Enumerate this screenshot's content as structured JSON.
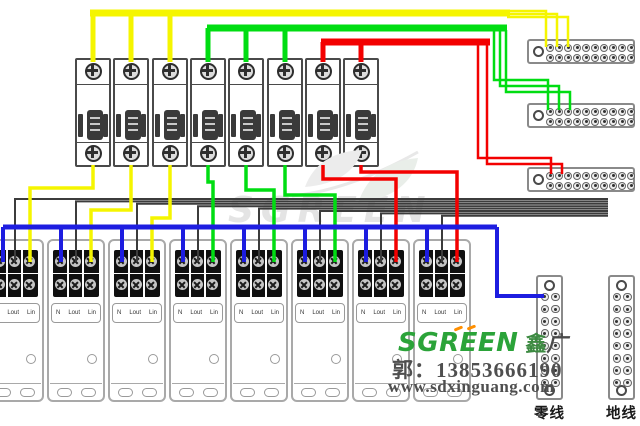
{
  "diagram": {
    "type": "electrical wiring diagram",
    "description": "Eight single-pole circuit breakers wired to eight single-phase energy meters; yellow/green/red phase buses feed terminal bus blocks, blue neutral bus feeds neutral strip"
  },
  "colors": {
    "yellow": "#f5f500",
    "green": "#00dd12",
    "red": "#f30000",
    "blue": "#1d1de0",
    "black": "#3c3c3c",
    "background": "#ffffff",
    "logo_green": "#2ba339",
    "logo_orange": "#ff8f00",
    "watermark_gray": "#e4e4e4"
  },
  "branding": {
    "logo_text": "SGREEN",
    "logo_cn_1": "鑫",
    "logo_cn_2": "广",
    "contact": "郭：13853666190",
    "website": "www.sdxinguang.com"
  },
  "watermark": {
    "text": "SGREEN"
  },
  "breakers": {
    "count": 8,
    "phases": [
      "yellow",
      "yellow",
      "yellow",
      "green",
      "green",
      "green",
      "red",
      "red"
    ]
  },
  "meters": {
    "count": 8,
    "terminal_labels": [
      "N",
      "Lout",
      "Lin"
    ]
  },
  "bus_blocks": {
    "count": 3,
    "rows": 2,
    "cols": 10,
    "feeds": [
      "yellow",
      "green",
      "red"
    ]
  },
  "strips": [
    {
      "label": "零线"
    },
    {
      "label": "地线"
    }
  ],
  "layout": {
    "breaker_xs": [
      75,
      113,
      152,
      190,
      228,
      267,
      305,
      343
    ],
    "meter_xs": [
      -14,
      47,
      108,
      169,
      230,
      291,
      352,
      413
    ],
    "tblock_ys": [
      39,
      103,
      167
    ],
    "strip_xs": [
      536,
      608
    ]
  },
  "wires": [
    {
      "c": "yellow",
      "w": 7,
      "pts": [
        [
          90,
          13
        ],
        [
          510,
          13
        ]
      ]
    },
    {
      "c": "yellow",
      "w": 5,
      "pts": [
        [
          93,
          13
        ],
        [
          93,
          62
        ]
      ]
    },
    {
      "c": "yellow",
      "w": 5,
      "pts": [
        [
          131,
          13
        ],
        [
          131,
          62
        ]
      ]
    },
    {
      "c": "yellow",
      "w": 5,
      "pts": [
        [
          170,
          13
        ],
        [
          170,
          62
        ]
      ]
    },
    {
      "c": "yellow",
      "w": 2.5,
      "pts": [
        [
          507,
          11
        ],
        [
          546,
          11
        ],
        [
          546,
          47
        ]
      ]
    },
    {
      "c": "yellow",
      "w": 2.5,
      "pts": [
        [
          507,
          14
        ],
        [
          557,
          14
        ],
        [
          557,
          47
        ]
      ]
    },
    {
      "c": "yellow",
      "w": 2.5,
      "pts": [
        [
          507,
          17
        ],
        [
          568,
          17
        ],
        [
          568,
          47
        ]
      ]
    },
    {
      "c": "green",
      "w": 7,
      "pts": [
        [
          207,
          28
        ],
        [
          507,
          28
        ]
      ]
    },
    {
      "c": "green",
      "w": 5,
      "pts": [
        [
          208,
          28
        ],
        [
          208,
          62
        ]
      ]
    },
    {
      "c": "green",
      "w": 5,
      "pts": [
        [
          246,
          28
        ],
        [
          246,
          62
        ]
      ]
    },
    {
      "c": "green",
      "w": 5,
      "pts": [
        [
          285,
          28
        ],
        [
          285,
          62
        ]
      ]
    },
    {
      "c": "green",
      "w": 2.5,
      "pts": [
        [
          494,
          30
        ],
        [
          494,
          80
        ],
        [
          548,
          80
        ],
        [
          548,
          110
        ]
      ]
    },
    {
      "c": "green",
      "w": 2.5,
      "pts": [
        [
          500,
          30
        ],
        [
          500,
          86
        ],
        [
          559,
          86
        ],
        [
          559,
          110
        ]
      ]
    },
    {
      "c": "green",
      "w": 2.5,
      "pts": [
        [
          506,
          30
        ],
        [
          506,
          92
        ],
        [
          570,
          92
        ],
        [
          570,
          110
        ]
      ]
    },
    {
      "c": "red",
      "w": 7,
      "pts": [
        [
          321,
          42
        ],
        [
          490,
          42
        ]
      ]
    },
    {
      "c": "red",
      "w": 5,
      "pts": [
        [
          323,
          42
        ],
        [
          323,
          62
        ]
      ]
    },
    {
      "c": "red",
      "w": 5,
      "pts": [
        [
          361,
          42
        ],
        [
          361,
          62
        ]
      ]
    },
    {
      "c": "red",
      "w": 2.5,
      "pts": [
        [
          478,
          44
        ],
        [
          478,
          158
        ],
        [
          551,
          158
        ],
        [
          551,
          174
        ]
      ]
    },
    {
      "c": "red",
      "w": 2.5,
      "pts": [
        [
          487,
          44
        ],
        [
          487,
          164
        ],
        [
          562,
          164
        ],
        [
          562,
          174
        ]
      ]
    },
    {
      "c": "black",
      "w": 2,
      "pts": [
        [
          15,
          262
        ],
        [
          15,
          199
        ],
        [
          608,
          199
        ]
      ]
    },
    {
      "c": "black",
      "w": 2,
      "pts": [
        [
          76,
          262
        ],
        [
          76,
          201.4
        ],
        [
          608,
          201.4
        ]
      ]
    },
    {
      "c": "black",
      "w": 2,
      "pts": [
        [
          137,
          262
        ],
        [
          137,
          203.8
        ],
        [
          608,
          203.8
        ]
      ]
    },
    {
      "c": "black",
      "w": 2,
      "pts": [
        [
          198,
          262
        ],
        [
          198,
          206.2
        ],
        [
          608,
          206.2
        ]
      ]
    },
    {
      "c": "black",
      "w": 2,
      "pts": [
        [
          259,
          262
        ],
        [
          259,
          208.6
        ],
        [
          608,
          208.6
        ]
      ]
    },
    {
      "c": "black",
      "w": 2,
      "pts": [
        [
          320,
          262
        ],
        [
          320,
          211
        ],
        [
          608,
          211
        ]
      ]
    },
    {
      "c": "black",
      "w": 2,
      "pts": [
        [
          381,
          262
        ],
        [
          381,
          213.4
        ],
        [
          608,
          213.4
        ]
      ]
    },
    {
      "c": "black",
      "w": 2,
      "pts": [
        [
          442,
          262
        ],
        [
          442,
          215.8
        ],
        [
          608,
          215.8
        ]
      ]
    },
    {
      "c": "yellow",
      "w": 3.5,
      "pts": [
        [
          93,
          165
        ],
        [
          93,
          188
        ],
        [
          30,
          188
        ],
        [
          30,
          262
        ]
      ]
    },
    {
      "c": "yellow",
      "w": 3.5,
      "pts": [
        [
          131,
          165
        ],
        [
          131,
          210
        ],
        [
          91,
          210
        ],
        [
          91,
          262
        ]
      ]
    },
    {
      "c": "yellow",
      "w": 3.5,
      "pts": [
        [
          170,
          165
        ],
        [
          170,
          218
        ],
        [
          152,
          218
        ],
        [
          152,
          262
        ]
      ]
    },
    {
      "c": "green",
      "w": 3.5,
      "pts": [
        [
          208,
          165
        ],
        [
          208,
          182
        ],
        [
          213,
          182
        ],
        [
          213,
          262
        ]
      ]
    },
    {
      "c": "green",
      "w": 3.5,
      "pts": [
        [
          246,
          165
        ],
        [
          246,
          190
        ],
        [
          274,
          190
        ],
        [
          274,
          262
        ]
      ]
    },
    {
      "c": "green",
      "w": 3.5,
      "pts": [
        [
          285,
          165
        ],
        [
          285,
          195
        ],
        [
          335,
          195
        ],
        [
          335,
          262
        ]
      ]
    },
    {
      "c": "red",
      "w": 3.5,
      "pts": [
        [
          323,
          165
        ],
        [
          323,
          179
        ],
        [
          396,
          179
        ],
        [
          396,
          262
        ]
      ]
    },
    {
      "c": "red",
      "w": 3.5,
      "pts": [
        [
          361,
          165
        ],
        [
          361,
          172
        ],
        [
          457,
          172
        ],
        [
          457,
          262
        ]
      ]
    },
    {
      "c": "blue",
      "w": 5,
      "pts": [
        [
          3,
          227
        ],
        [
          497,
          227
        ]
      ]
    },
    {
      "c": "blue",
      "w": 4,
      "pts": [
        [
          3,
          227
        ],
        [
          3,
          262
        ]
      ]
    },
    {
      "c": "blue",
      "w": 4,
      "pts": [
        [
          61,
          227
        ],
        [
          61,
          262
        ]
      ]
    },
    {
      "c": "blue",
      "w": 4,
      "pts": [
        [
          122,
          227
        ],
        [
          122,
          262
        ]
      ]
    },
    {
      "c": "blue",
      "w": 4,
      "pts": [
        [
          183,
          227
        ],
        [
          183,
          262
        ]
      ]
    },
    {
      "c": "blue",
      "w": 4,
      "pts": [
        [
          244,
          227
        ],
        [
          244,
          262
        ]
      ]
    },
    {
      "c": "blue",
      "w": 4,
      "pts": [
        [
          305,
          227
        ],
        [
          305,
          262
        ]
      ]
    },
    {
      "c": "blue",
      "w": 4,
      "pts": [
        [
          366,
          227
        ],
        [
          366,
          262
        ]
      ]
    },
    {
      "c": "blue",
      "w": 4,
      "pts": [
        [
          427,
          227
        ],
        [
          427,
          262
        ]
      ]
    },
    {
      "c": "blue",
      "w": 4,
      "pts": [
        [
          497,
          227
        ],
        [
          497,
          296
        ],
        [
          544,
          296
        ]
      ]
    }
  ]
}
